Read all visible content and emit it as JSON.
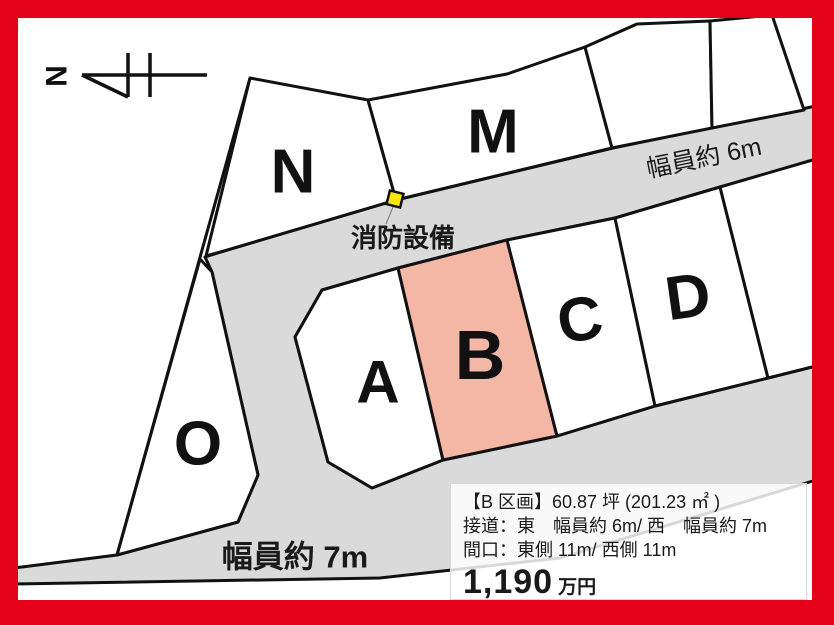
{
  "colors": {
    "frame": "#E50019",
    "road": "#DADADA",
    "highlight": "#F4B7A6",
    "marker_yellow": "#FFE607"
  },
  "map": {
    "north_label": "N",
    "plot_labels": {
      "n": "N",
      "m": "M",
      "o": "O",
      "a": "A",
      "b": "B",
      "c": "C",
      "d": "D"
    },
    "road_width_top_label": "幅員約 6m",
    "road_width_bottom_label": "幅員約 7m",
    "fire_equipment_label": "消防設備"
  },
  "info_box": {
    "title": "【B 区画】60.87 坪 (201.23 ㎡ )",
    "access": "接道：東　幅員約 6m/ 西　幅員約 7m",
    "frontage": "間口：東側 11m/ 西側 11m",
    "price": "1,190",
    "price_unit": "万円"
  }
}
